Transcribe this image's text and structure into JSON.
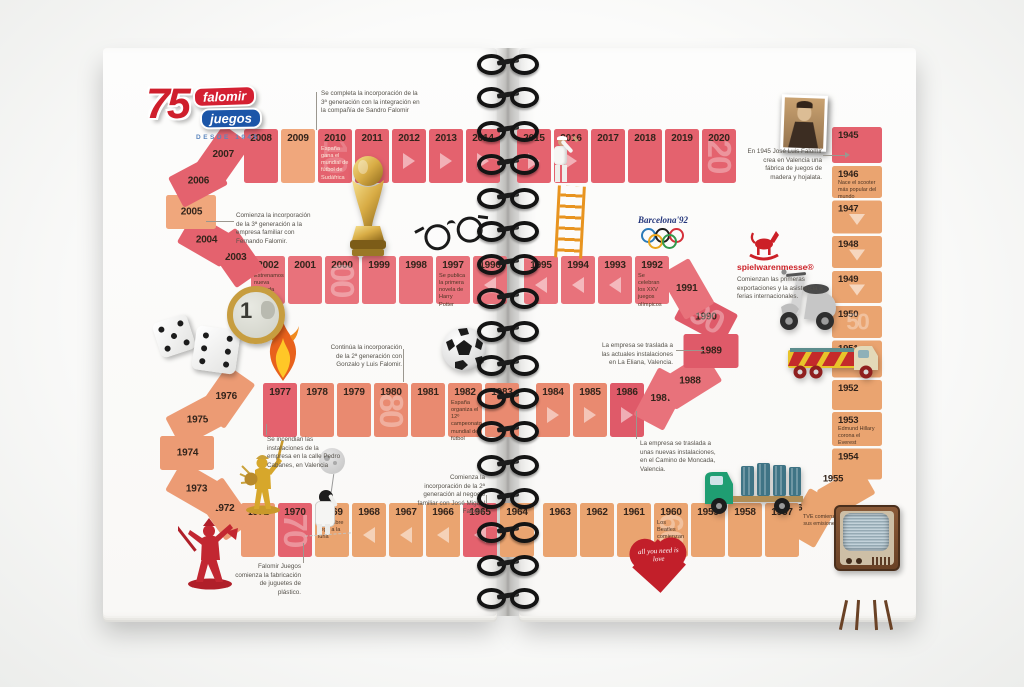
{
  "logo": {
    "number": "75",
    "brand": "falomir",
    "sub": "juegos",
    "tagline": "DESDE 1945"
  },
  "events": {
    "barcelona": "Barcelona'92",
    "spielwarenmesse": "spielwarenmesse®",
    "spielwarenmesse_note": "Comienzan las primeras exportaciones y la asistencia a ferias internacionales.",
    "heart_text": "all you need is love"
  },
  "cells": [
    {
      "year": "1945"
    },
    {
      "year": "1946",
      "note": "Nace el scooter más popular del mundo"
    },
    {
      "year": "1947",
      "arrow": "d"
    },
    {
      "year": "1948",
      "arrow": "d"
    },
    {
      "year": "1949",
      "arrow": "d"
    },
    {
      "year": "1950",
      "wm": "50"
    },
    {
      "year": "1951"
    },
    {
      "year": "1952"
    },
    {
      "year": "1953",
      "note": "Edmund Hillary corona el Everest"
    },
    {
      "year": "1954"
    },
    {
      "year": "1955"
    },
    {
      "year": "1956",
      "note": "TVE comienza sus emisiones"
    },
    {
      "year": "1957"
    },
    {
      "year": "1958"
    },
    {
      "year": "1959"
    },
    {
      "year": "1960",
      "note": "Los Beatles comienzan su carrera",
      "wm": "60"
    },
    {
      "year": "1961"
    },
    {
      "year": "1962"
    },
    {
      "year": "1963"
    },
    {
      "year": "1964"
    },
    {
      "year": "1965",
      "arrow": "l"
    },
    {
      "year": "1966",
      "arrow": "l"
    },
    {
      "year": "1967",
      "arrow": "l"
    },
    {
      "year": "1968",
      "arrow": "l"
    },
    {
      "year": "1969",
      "note": "El hombre llega a la luna"
    },
    {
      "year": "1970",
      "wm": "70"
    },
    {
      "year": "1971"
    },
    {
      "year": "1972"
    },
    {
      "year": "1973"
    },
    {
      "year": "1974"
    },
    {
      "year": "1975"
    },
    {
      "year": "1976"
    },
    {
      "year": "1977"
    },
    {
      "year": "1978"
    },
    {
      "year": "1979"
    },
    {
      "year": "1980",
      "wm": "80"
    },
    {
      "year": "1981"
    },
    {
      "year": "1982",
      "note": "España organiza el 12º campeonato mundial de fútbol"
    },
    {
      "year": "1983"
    },
    {
      "year": "1984",
      "arrow": "r"
    },
    {
      "year": "1985",
      "arrow": "r"
    },
    {
      "year": "1986",
      "arrow": "r"
    },
    {
      "year": "1987"
    },
    {
      "year": "1988"
    },
    {
      "year": "1989"
    },
    {
      "year": "1990",
      "wm": "90"
    },
    {
      "year": "1991"
    },
    {
      "year": "1992",
      "note": "Se celebran los XXV juegos olímpicos"
    },
    {
      "year": "1993",
      "arrow": "l"
    },
    {
      "year": "1994",
      "arrow": "l"
    },
    {
      "year": "1995",
      "arrow": "l"
    },
    {
      "year": "1996",
      "arrow": "l"
    },
    {
      "year": "1997",
      "note": "Se publica la primera novela de Harry Potter"
    },
    {
      "year": "1998"
    },
    {
      "year": "1999"
    },
    {
      "year": "2000",
      "wm": "00"
    },
    {
      "year": "2001"
    },
    {
      "year": "2002",
      "note": "Estrenamos nueva moneda"
    },
    {
      "year": "2003"
    },
    {
      "year": "2004"
    },
    {
      "year": "2005"
    },
    {
      "year": "2006"
    },
    {
      "year": "2007"
    },
    {
      "year": "2008"
    },
    {
      "year": "2009"
    },
    {
      "year": "2010",
      "note": "España gana el mundial de fútbol de Sudáfrica",
      "wm": "10",
      "light": true
    },
    {
      "year": "2011"
    },
    {
      "year": "2012",
      "arrow": "r"
    },
    {
      "year": "2013",
      "arrow": "r"
    },
    {
      "year": "2014",
      "arrow": "r"
    },
    {
      "year": "2015",
      "arrow": "r"
    },
    {
      "year": "2016",
      "arrow": "r"
    },
    {
      "year": "2017"
    },
    {
      "year": "2018"
    },
    {
      "year": "2019"
    },
    {
      "year": "2020",
      "wm": "20"
    }
  ],
  "annotations": [
    {
      "id": "a2009",
      "text": "Se completa la incorporación de la 3ª generación con la integración en la compañía de Sandro Falomir"
    },
    {
      "id": "a2005",
      "text": "Comienza la incorporación de la 3ª generación a la empresa familiar con Fernando Falomir."
    },
    {
      "id": "a1980",
      "text": "Continúa la incorporación de la 2ª generación con Gonzalo y Luis Falomir."
    },
    {
      "id": "a1977",
      "text": "Se incendian las instalaciones de la empresa en la calle Pedro Cabanes, en Valencia"
    },
    {
      "id": "a1970",
      "text": "Falomir Juegos comienza la fabricación de juguetes de plástico."
    },
    {
      "id": "a1964",
      "text": "Comienza la incorporación de la 2ª generación al negocio familiar con José Miguel Falomir."
    },
    {
      "id": "a1989",
      "text": "La empresa se traslada a las actuales instalaciones en La Eliana, Valencia."
    },
    {
      "id": "a1986",
      "text": "La empresa se traslada a unas nuevas instalaciones, en el Camino de Moncada, Valencia."
    },
    {
      "id": "a1945",
      "text": "En 1945 José Luis Falomir crea en Valencia una fábrica de juegos de madera y hojalata."
    }
  ]
}
